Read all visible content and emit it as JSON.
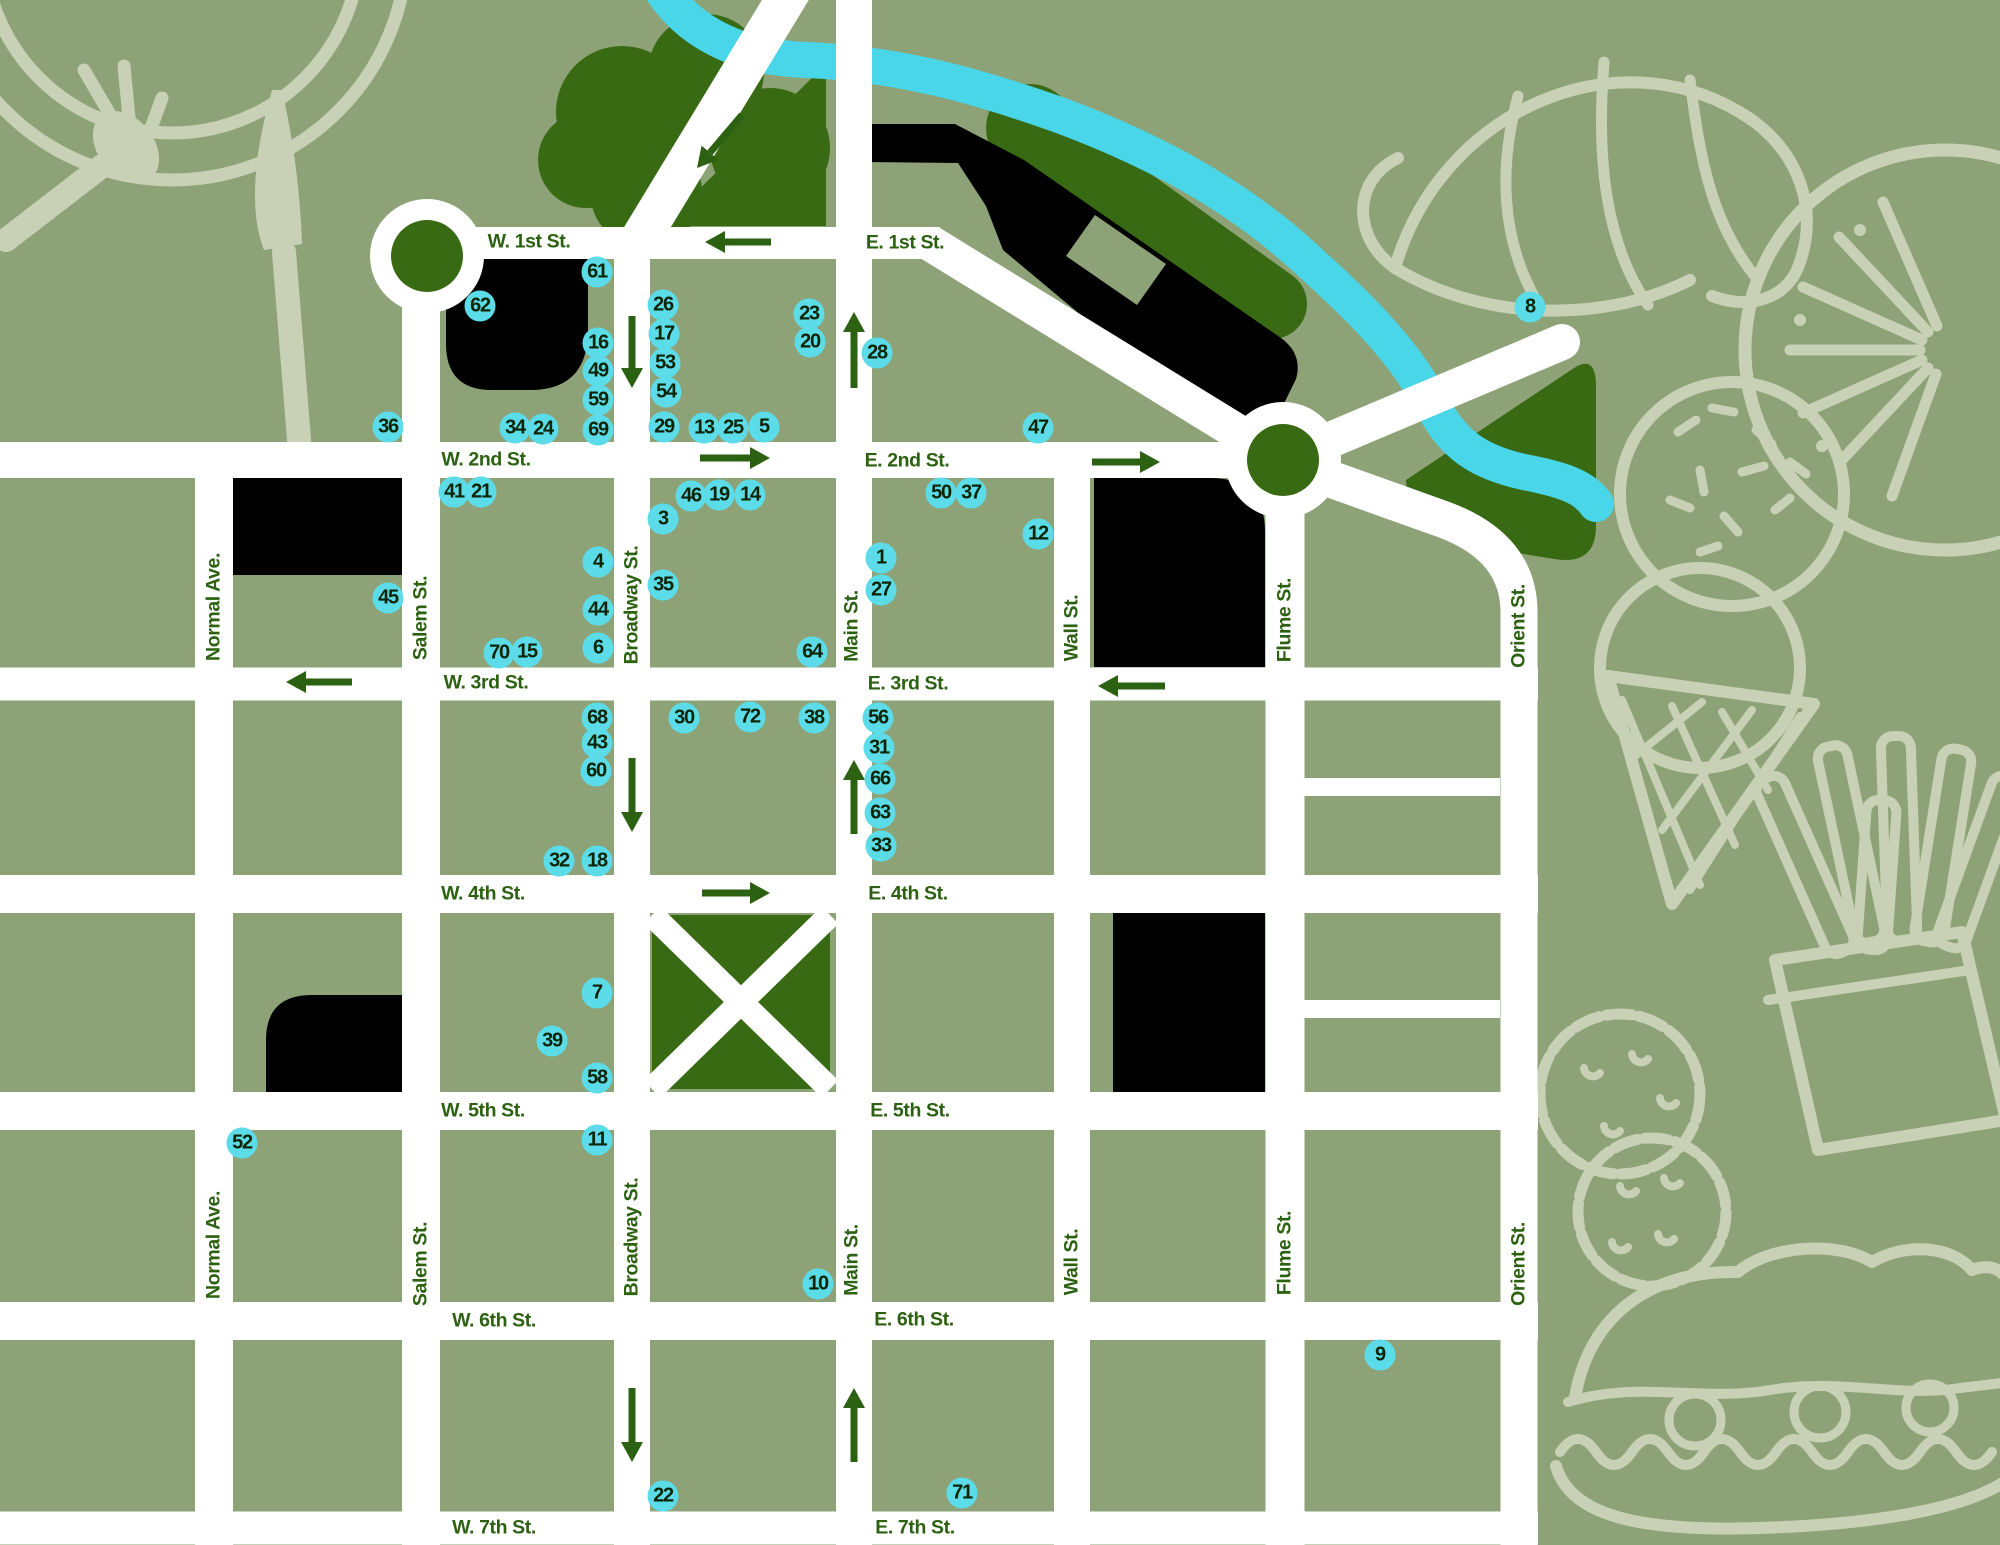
{
  "theme": {
    "background": "#8da377",
    "street": "#ffffff",
    "park": "#386a13",
    "label": "#2b6111",
    "river": "#48d6e8",
    "marker": "#5cdbe8",
    "marker_text": "#0c2405",
    "building": "#000000",
    "illustration": "#c8d1b6"
  },
  "map": {
    "street_labels": [
      {
        "text": "W. 1st St.",
        "x": 529,
        "y": 242,
        "v": false
      },
      {
        "text": "E. 1st St.",
        "x": 905,
        "y": 243,
        "v": false
      },
      {
        "text": "W. 2nd St.",
        "x": 486,
        "y": 460,
        "v": false
      },
      {
        "text": "E. 2nd St.",
        "x": 907,
        "y": 461,
        "v": false
      },
      {
        "text": "W. 3rd St.",
        "x": 486,
        "y": 683,
        "v": false
      },
      {
        "text": "E. 3rd St.",
        "x": 908,
        "y": 684,
        "v": false
      },
      {
        "text": "W. 4th St.",
        "x": 483,
        "y": 894,
        "v": false
      },
      {
        "text": "E. 4th St.",
        "x": 908,
        "y": 894,
        "v": false
      },
      {
        "text": "W. 5th St.",
        "x": 483,
        "y": 1111,
        "v": false
      },
      {
        "text": "E. 5th St.",
        "x": 910,
        "y": 1111,
        "v": false
      },
      {
        "text": "W. 6th St.",
        "x": 494,
        "y": 1321,
        "v": false
      },
      {
        "text": "E. 6th St.",
        "x": 914,
        "y": 1320,
        "v": false
      },
      {
        "text": "W. 7th St.",
        "x": 494,
        "y": 1528,
        "v": false
      },
      {
        "text": "E. 7th St.",
        "x": 915,
        "y": 1528,
        "v": false
      },
      {
        "text": "Normal Ave.",
        "x": 214,
        "y": 607,
        "v": true
      },
      {
        "text": "Normal Ave.",
        "x": 214,
        "y": 1245,
        "v": true
      },
      {
        "text": "Salem St.",
        "x": 421,
        "y": 618,
        "v": true
      },
      {
        "text": "Salem St.",
        "x": 421,
        "y": 1264,
        "v": true
      },
      {
        "text": "Broadway St.",
        "x": 632,
        "y": 605,
        "v": true
      },
      {
        "text": "Broadway St.",
        "x": 632,
        "y": 1237,
        "v": true
      },
      {
        "text": "Main St.",
        "x": 852,
        "y": 626,
        "v": true
      },
      {
        "text": "Main St.",
        "x": 852,
        "y": 1260,
        "v": true
      },
      {
        "text": "Wall St.",
        "x": 1072,
        "y": 628,
        "v": true
      },
      {
        "text": "Wall St.",
        "x": 1072,
        "y": 1262,
        "v": true
      },
      {
        "text": "Flume St.",
        "x": 1285,
        "y": 620,
        "v": true
      },
      {
        "text": "Flume St.",
        "x": 1285,
        "y": 1253,
        "v": true
      },
      {
        "text": "Orient St.",
        "x": 1519,
        "y": 626,
        "v": true
      },
      {
        "text": "Orient St.",
        "x": 1519,
        "y": 1264,
        "v": true
      }
    ],
    "markers": [
      {
        "n": 61,
        "x": 597,
        "y": 272
      },
      {
        "n": 62,
        "x": 480,
        "y": 306
      },
      {
        "n": 16,
        "x": 598,
        "y": 343
      },
      {
        "n": 49,
        "x": 598,
        "y": 371
      },
      {
        "n": 59,
        "x": 598,
        "y": 400
      },
      {
        "n": 26,
        "x": 663,
        "y": 305
      },
      {
        "n": 17,
        "x": 664,
        "y": 334
      },
      {
        "n": 53,
        "x": 665,
        "y": 363
      },
      {
        "n": 54,
        "x": 666,
        "y": 392
      },
      {
        "n": 23,
        "x": 809,
        "y": 314
      },
      {
        "n": 20,
        "x": 810,
        "y": 342
      },
      {
        "n": 28,
        "x": 877,
        "y": 353
      },
      {
        "n": 47,
        "x": 1038,
        "y": 428
      },
      {
        "n": 8,
        "x": 1530,
        "y": 307
      },
      {
        "n": 36,
        "x": 388,
        "y": 427
      },
      {
        "n": 34,
        "x": 515,
        "y": 428
      },
      {
        "n": 24,
        "x": 543,
        "y": 429
      },
      {
        "n": 69,
        "x": 598,
        "y": 430
      },
      {
        "n": 29,
        "x": 664,
        "y": 427
      },
      {
        "n": 13,
        "x": 704,
        "y": 428
      },
      {
        "n": 25,
        "x": 733,
        "y": 428
      },
      {
        "n": 5,
        "x": 764,
        "y": 427
      },
      {
        "n": 41,
        "x": 454,
        "y": 492
      },
      {
        "n": 21,
        "x": 481,
        "y": 492
      },
      {
        "n": 46,
        "x": 691,
        "y": 496
      },
      {
        "n": 19,
        "x": 719,
        "y": 495
      },
      {
        "n": 14,
        "x": 750,
        "y": 495
      },
      {
        "n": 3,
        "x": 663,
        "y": 519
      },
      {
        "n": 50,
        "x": 941,
        "y": 493
      },
      {
        "n": 37,
        "x": 971,
        "y": 493
      },
      {
        "n": 12,
        "x": 1038,
        "y": 534
      },
      {
        "n": 1,
        "x": 881,
        "y": 558
      },
      {
        "n": 27,
        "x": 881,
        "y": 590
      },
      {
        "n": 45,
        "x": 388,
        "y": 598
      },
      {
        "n": 4,
        "x": 598,
        "y": 562
      },
      {
        "n": 35,
        "x": 663,
        "y": 585
      },
      {
        "n": 44,
        "x": 598,
        "y": 610
      },
      {
        "n": 6,
        "x": 598,
        "y": 648
      },
      {
        "n": 70,
        "x": 499,
        "y": 653
      },
      {
        "n": 15,
        "x": 527,
        "y": 652
      },
      {
        "n": 64,
        "x": 812,
        "y": 652
      },
      {
        "n": 68,
        "x": 597,
        "y": 718
      },
      {
        "n": 43,
        "x": 597,
        "y": 743
      },
      {
        "n": 60,
        "x": 596,
        "y": 771
      },
      {
        "n": 30,
        "x": 684,
        "y": 718
      },
      {
        "n": 72,
        "x": 750,
        "y": 717
      },
      {
        "n": 38,
        "x": 814,
        "y": 718
      },
      {
        "n": 56,
        "x": 878,
        "y": 718
      },
      {
        "n": 31,
        "x": 879,
        "y": 748
      },
      {
        "n": 66,
        "x": 880,
        "y": 779
      },
      {
        "n": 63,
        "x": 880,
        "y": 813
      },
      {
        "n": 33,
        "x": 881,
        "y": 846
      },
      {
        "n": 32,
        "x": 559,
        "y": 861
      },
      {
        "n": 18,
        "x": 597,
        "y": 861
      },
      {
        "n": 7,
        "x": 597,
        "y": 993
      },
      {
        "n": 39,
        "x": 552,
        "y": 1041
      },
      {
        "n": 58,
        "x": 597,
        "y": 1078
      },
      {
        "n": 52,
        "x": 242,
        "y": 1143
      },
      {
        "n": 11,
        "x": 597,
        "y": 1140
      },
      {
        "n": 10,
        "x": 818,
        "y": 1284
      },
      {
        "n": 22,
        "x": 663,
        "y": 1496
      },
      {
        "n": 71,
        "x": 962,
        "y": 1493
      },
      {
        "n": 9,
        "x": 1380,
        "y": 1355
      }
    ],
    "arrows": [
      {
        "x1": 771,
        "y1": 242,
        "x2": 705,
        "y2": 242
      },
      {
        "x1": 742,
        "y1": 115,
        "x2": 697,
        "y2": 168
      },
      {
        "x1": 632,
        "y1": 316,
        "x2": 632,
        "y2": 388
      },
      {
        "x1": 854,
        "y1": 388,
        "x2": 854,
        "y2": 312
      },
      {
        "x1": 700,
        "y1": 458,
        "x2": 770,
        "y2": 458
      },
      {
        "x1": 1092,
        "y1": 462,
        "x2": 1160,
        "y2": 462
      },
      {
        "x1": 352,
        "y1": 682,
        "x2": 286,
        "y2": 682
      },
      {
        "x1": 1165,
        "y1": 686,
        "x2": 1098,
        "y2": 686
      },
      {
        "x1": 632,
        "y1": 758,
        "x2": 632,
        "y2": 832
      },
      {
        "x1": 854,
        "y1": 834,
        "x2": 854,
        "y2": 760
      },
      {
        "x1": 702,
        "y1": 893,
        "x2": 770,
        "y2": 893
      },
      {
        "x1": 632,
        "y1": 1388,
        "x2": 632,
        "y2": 1462
      },
      {
        "x1": 854,
        "y1": 1462,
        "x2": 854,
        "y2": 1388
      }
    ]
  }
}
